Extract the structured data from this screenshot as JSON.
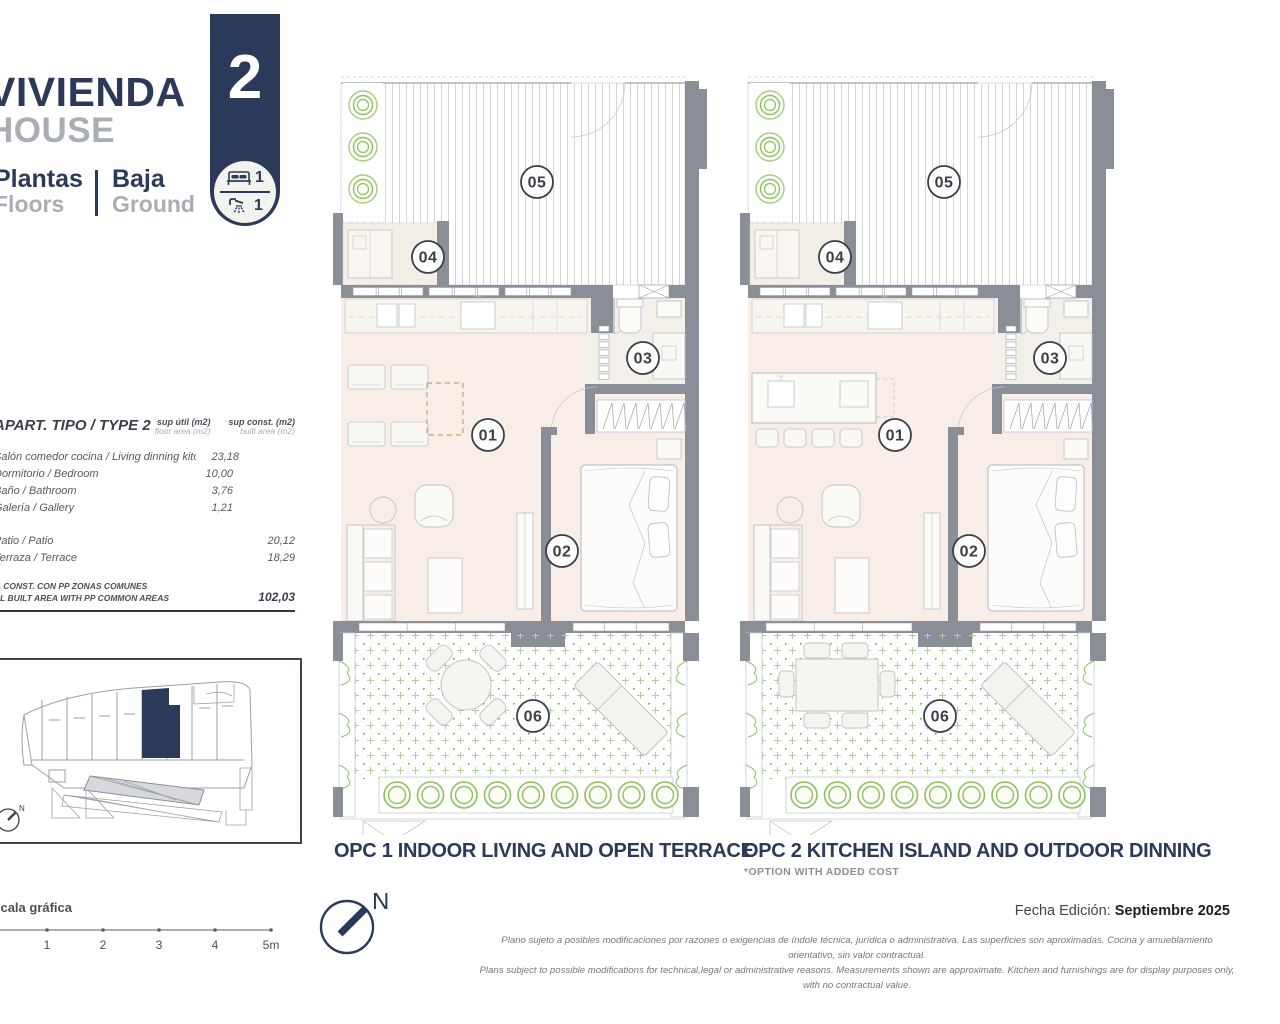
{
  "header": {
    "title_es": "VIVIENDA",
    "title_en": "HOUSE",
    "floors_label_es": "Plantas",
    "floors_label_en": "Floors",
    "floor_value_es": "Baja",
    "floor_value_en": "Ground",
    "unit_number": "2",
    "bedrooms": "1",
    "bathrooms": "1"
  },
  "area_table": {
    "title": "APART. TIPO / TYPE 2",
    "col1_header": "sup útil (m2)",
    "col1_subheader": "floor area (m2)",
    "col2_header": "sup const. (m2)",
    "col2_subheader": "built area (m2)",
    "rows": [
      {
        "label": "Salón comedor cocina / Living dinning kitchen",
        "util": "23,18",
        "const": ""
      },
      {
        "label": "Dormitorio / Bedroom",
        "util": "10,00",
        "const": ""
      },
      {
        "label": "Baño / Bathroom",
        "util": "3,76",
        "const": ""
      },
      {
        "label": "Galería / Gallery",
        "util": "1,21",
        "const": ""
      },
      {
        "spacer": true
      },
      {
        "label": "Patio / Patio",
        "util": "",
        "const": "20,12"
      },
      {
        "label": "Terraza / Terrace",
        "util": "",
        "const": "18,29"
      }
    ],
    "total_label_line1": "P. CONST. CON PP ZONAS COMUNES",
    "total_label_line2": "AL BUILT AREA WITH PP COMMON AREAS",
    "total_value": "102,03"
  },
  "plans": [
    {
      "id": "opc1",
      "title": "OPC 1 INDOOR LIVING AND OPEN TERRACE",
      "note": "",
      "room_labels": [
        "01",
        "02",
        "03",
        "04",
        "05",
        "06"
      ]
    },
    {
      "id": "opc2",
      "title": "OPC 2 KITCHEN ISLAND AND OUTDOOR DINNING",
      "note": "*OPTION WITH ADDED COST",
      "room_labels": [
        "01",
        "02",
        "03",
        "04",
        "05",
        "06"
      ]
    }
  ],
  "footer": {
    "scale_label": "escala gráfica",
    "scale_ticks": [
      "1",
      "2",
      "3",
      "4",
      "5m"
    ],
    "north_label": "N",
    "edition_label": "Fecha Edición:",
    "edition_value": "Septiembre 2025",
    "disclaimer_es": "Plano sujeto a posibles modificaciones por razones o exigencias de índole técnica,  jurídica o administrativa. Las superficies son aproximadas. Cocina y amueblamiento orientativo, sin valor contractual.",
    "disclaimer_en": "Plans subject to possible modifications for technical,legal or administrative reasons. Measurements shown are approximate. Kitchen and furnishings are for display purposes only, with no contractual value."
  },
  "colors": {
    "navy": "#2c3a59",
    "gray_label": "#a9adb4",
    "wall": "#8a8e97",
    "interior_floor": "#f8eee7",
    "bath_floor": "#f3f0ea",
    "plant_green": "#8fbf63",
    "patio_cross": "#b3cc9c",
    "patio_dot": "#76a554"
  }
}
